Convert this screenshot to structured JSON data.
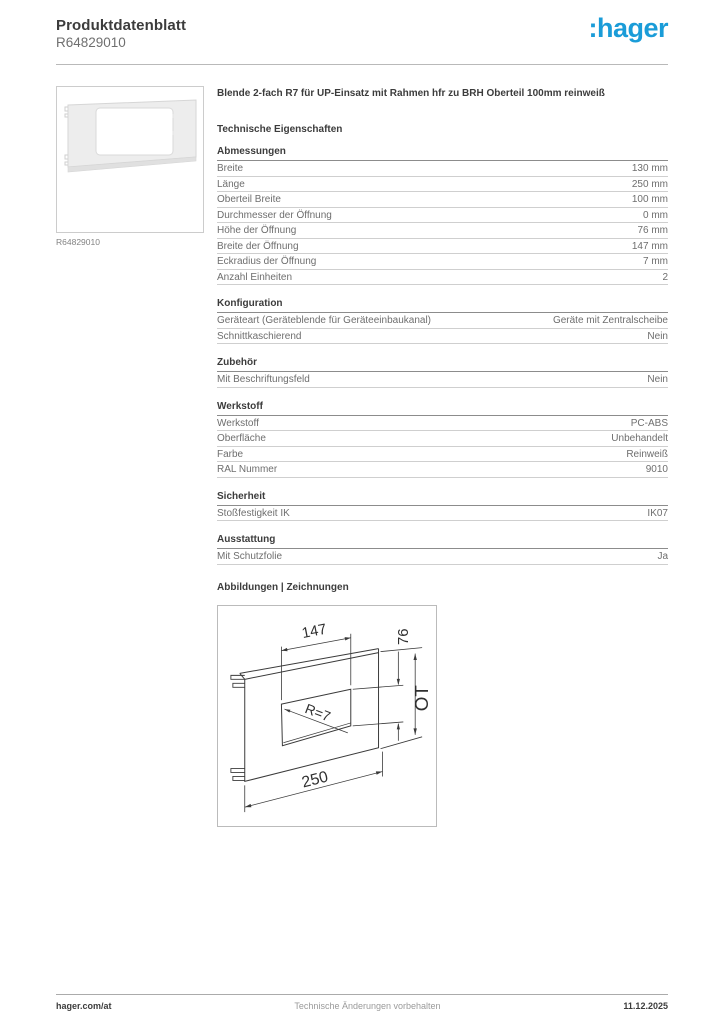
{
  "header": {
    "title": "Produktdatenblatt",
    "product_ref": "R64829010",
    "logo_text": ":hager",
    "brand_color": "#1a9cd8"
  },
  "product": {
    "image_caption": "R64829010",
    "description": "Blende 2-fach R7 für UP-Einsatz mit Rahmen hfr zu BRH Oberteil 100mm reinweiß"
  },
  "technical": {
    "heading": "Technische Eigenschaften",
    "sections": [
      {
        "title": "Abmessungen",
        "rows": [
          {
            "label": "Breite",
            "value": "130 mm"
          },
          {
            "label": "Länge",
            "value": "250 mm"
          },
          {
            "label": "Oberteil Breite",
            "value": "100 mm"
          },
          {
            "label": "Durchmesser der Öffnung",
            "value": "0 mm"
          },
          {
            "label": "Höhe der Öffnung",
            "value": "76 mm"
          },
          {
            "label": "Breite der Öffnung",
            "value": "147 mm"
          },
          {
            "label": "Eckradius der Öffnung",
            "value": "7 mm"
          },
          {
            "label": "Anzahl Einheiten",
            "value": "2"
          }
        ]
      },
      {
        "title": "Konfiguration",
        "rows": [
          {
            "label": "Geräteart (Geräteblende für Geräteeinbaukanal)",
            "value": "Geräte mit Zentralscheibe"
          },
          {
            "label": "Schnittkaschierend",
            "value": "Nein"
          }
        ]
      },
      {
        "title": "Zubehör",
        "rows": [
          {
            "label": "Mit Beschriftungsfeld",
            "value": "Nein"
          }
        ]
      },
      {
        "title": "Werkstoff",
        "rows": [
          {
            "label": "Werkstoff",
            "value": "PC-ABS"
          },
          {
            "label": "Oberfläche",
            "value": "Unbehandelt"
          },
          {
            "label": "Farbe",
            "value": "Reinweiß"
          },
          {
            "label": "RAL Nummer",
            "value": "9010"
          }
        ]
      },
      {
        "title": "Sicherheit",
        "rows": [
          {
            "label": "Stoßfestigkeit IK",
            "value": "IK07"
          }
        ]
      },
      {
        "title": "Ausstattung",
        "rows": [
          {
            "label": "Mit Schutzfolie",
            "value": "Ja"
          }
        ]
      }
    ]
  },
  "drawings": {
    "heading": "Abbildungen | Zeichnungen",
    "labels": {
      "opening_width": "147",
      "opening_height": "76",
      "oberteil": "OT",
      "length": "250",
      "radius": "R=7"
    }
  },
  "footer": {
    "left": "hager.com/at",
    "center": "Technische Änderungen vorbehalten",
    "right": "11.12.2025"
  }
}
